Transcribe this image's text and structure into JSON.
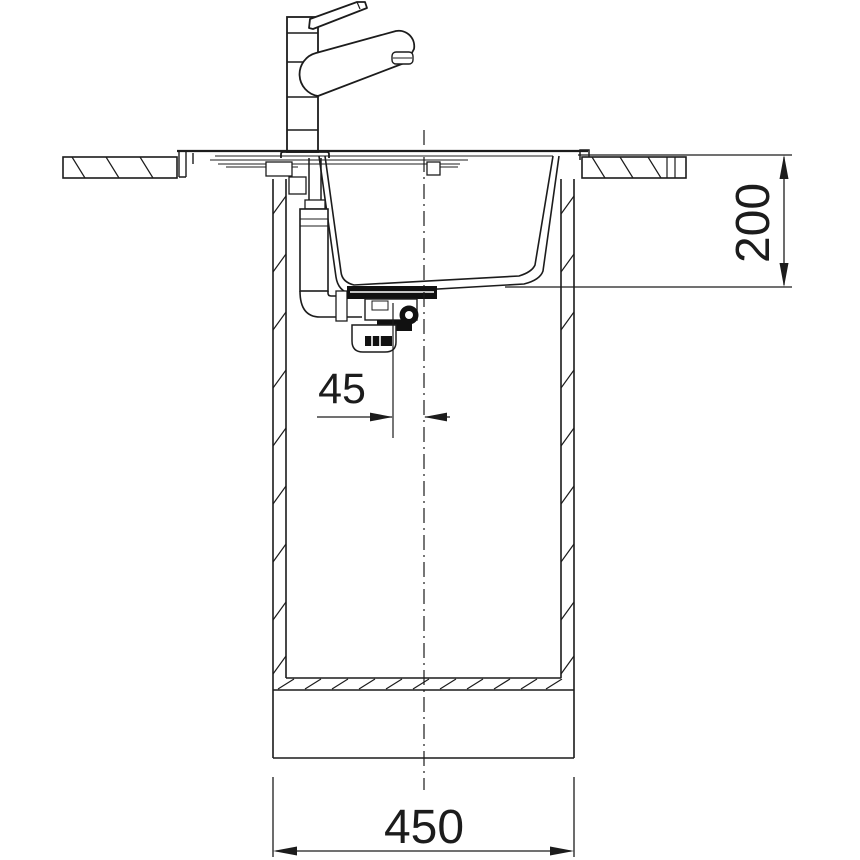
{
  "drawing": {
    "title": "Kitchen sink installation drawing — side cross-section",
    "background_color": "#ffffff",
    "line_color": "#1c1c1c",
    "dark_fill_color": "#111111",
    "dimensions": {
      "bowl_depth": {
        "value": "200",
        "orientation": "vertical-right"
      },
      "drain_offset": {
        "value": "45",
        "orientation": "horizontal-middle"
      },
      "cabinet_width": {
        "value": "450",
        "orientation": "horizontal-bottom"
      }
    },
    "components": [
      "mixer-tap",
      "countertop-left",
      "countertop-right",
      "inset-sink-bowl",
      "overflow-pipe",
      "drain-trap-assembly",
      "base-cabinet",
      "centre-line"
    ]
  }
}
